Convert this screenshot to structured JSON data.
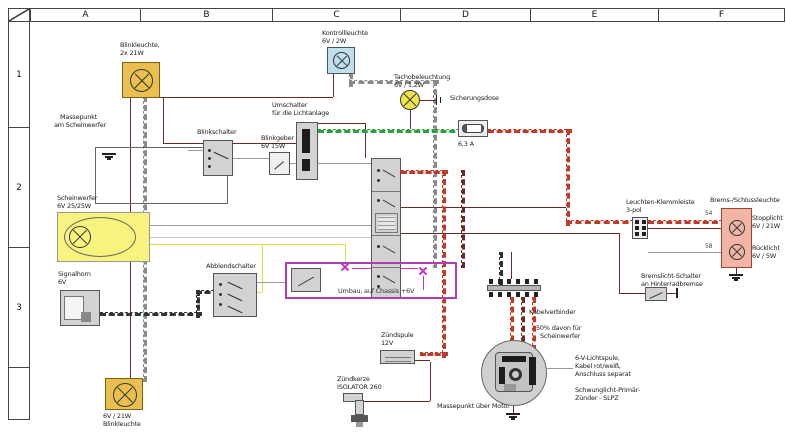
{
  "frame": {
    "columns": [
      "A",
      "B",
      "C",
      "D",
      "E",
      "F"
    ],
    "rows": [
      "1",
      "2",
      "3"
    ]
  },
  "components": {
    "blinker_front": {
      "l1": "Blinkleuchte,",
      "l2": "2x 21W"
    },
    "masse_scheinwerfer": {
      "l1": "Massepunkt",
      "l2": "am Scheinwerfer"
    },
    "scheinwerfer": {
      "l1": "Scheinwerfer",
      "l2": "6V 25/25W"
    },
    "signalhorn": {
      "l1": "Signalhorn",
      "l2": "6V"
    },
    "blinkschalter": {
      "l1": "Blinkschalter"
    },
    "blinkgeber": {
      "l1": "Blinkgeber",
      "l2": "6V 15W"
    },
    "lichtumschalter": {
      "l1": "Umschalter",
      "l2": "für die Lichtanlage"
    },
    "kontrollleuchte": {
      "l1": "Kontrollleuchte",
      "l2": "6V / 2W"
    },
    "tachobeleuchtung": {
      "l1": "Tachobeleuchtung",
      "l2": "6V / 1,2W"
    },
    "sicherung": {
      "l1": "Sicherungsdose",
      "rating": "6,3 A"
    },
    "abblendschalter": {
      "l1": "Abblendschalter"
    },
    "umbau": {
      "l1": "Umbau, auf Chassis +6V"
    },
    "zuendspule": {
      "l1": "Zündspule",
      "l2": "12V"
    },
    "zuendkerze": {
      "l1": "Zündkerze",
      "l2": "ISOLATOR 260"
    },
    "masse_motor": {
      "l1": "Massepunkt über Motor"
    },
    "kabelverbinder": {
      "l1": "Kabelverbinder"
    },
    "magneto": {
      "pct1": "50% davon für",
      "pct2": "Scheinwerfer",
      "coil1": "6-V-Lichtspule,",
      "coil2": "Kabel rot/weiß,",
      "coil3": "Anschluss separat",
      "name1": "Schwunglicht-Primär-",
      "name2": "Zünder - SLPZ"
    },
    "klemmleiste": {
      "l1": "Leuchten-Klemmleiste",
      "l2": "3-pol"
    },
    "bremsschluss": {
      "title": "Brems-/Schlussleuchte",
      "stop1": "Stopplicht",
      "stop2": "6V / 21W",
      "rueck1": "Rücklicht",
      "rueck2": "6V / 5W"
    },
    "bremsschalter": {
      "l1": "Bremslicht-Schalter",
      "l2": "an Hinterradbremse"
    },
    "blinker_rear": {
      "l1": "6V / 21W",
      "l2": "Blinkleuchte"
    }
  },
  "wire_labels": {
    "stop_feed": "54",
    "tail_feed": "58"
  },
  "colors": {
    "wire_main": "#6b2a28",
    "wire_switched": "#c03a2a",
    "wire_ground": "#333333",
    "wire_green": "#2f9e44",
    "wire_yellow": "#e3dc45",
    "annotation_magenta": "#c233c2",
    "lamp_yellow": "#e9c050",
    "headlight_yellow": "#f7f37e",
    "indicator_blue": "#bfe0ea",
    "tail_pink": "#f0b5a5"
  }
}
